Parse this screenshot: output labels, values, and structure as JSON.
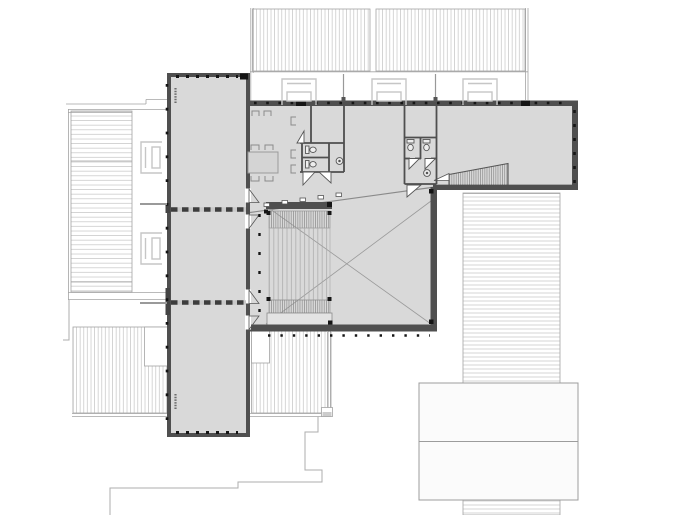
{
  "document": {
    "kind": "architectural floor plan",
    "view": "upper floor plan of T-shaped building with surrounding roofs and site outline",
    "readable_text": "none (only tiny illegible room-label marks)"
  },
  "colors": {
    "background": "#ffffff",
    "floor": "#d9d9d9",
    "floor_light": "#e7e7e7",
    "wall": "#4f4f4f",
    "dashed_wall": "#3d3d3d",
    "hatch": "#c4c4c4",
    "roof_edge": "#a3a3a3",
    "site_outline": "#adadad",
    "tick_black": "#151515",
    "tread": "#8c8c8c",
    "tread_light": "#a8a8a8",
    "furniture": "#8a8a8a",
    "bench": "#c6c6c6",
    "fixture": "#555555",
    "label_mark": "#5a5a5a",
    "white": "#ffffff"
  },
  "inventory": {
    "roof_planes_hatched": 6,
    "north_benches": 3,
    "west_benches": 2,
    "wc_stalls": 4,
    "washbasins": 2,
    "toilets": 4,
    "stair": "two flights with top beam and lower landing",
    "void_marker": "diagonal X cross over central hall",
    "ramp": "hatched sloping ramp at east wing",
    "meeting_table_chairs": 6,
    "door_swings": 10,
    "dashed_partition_walls": 2,
    "label_marks": 2
  }
}
